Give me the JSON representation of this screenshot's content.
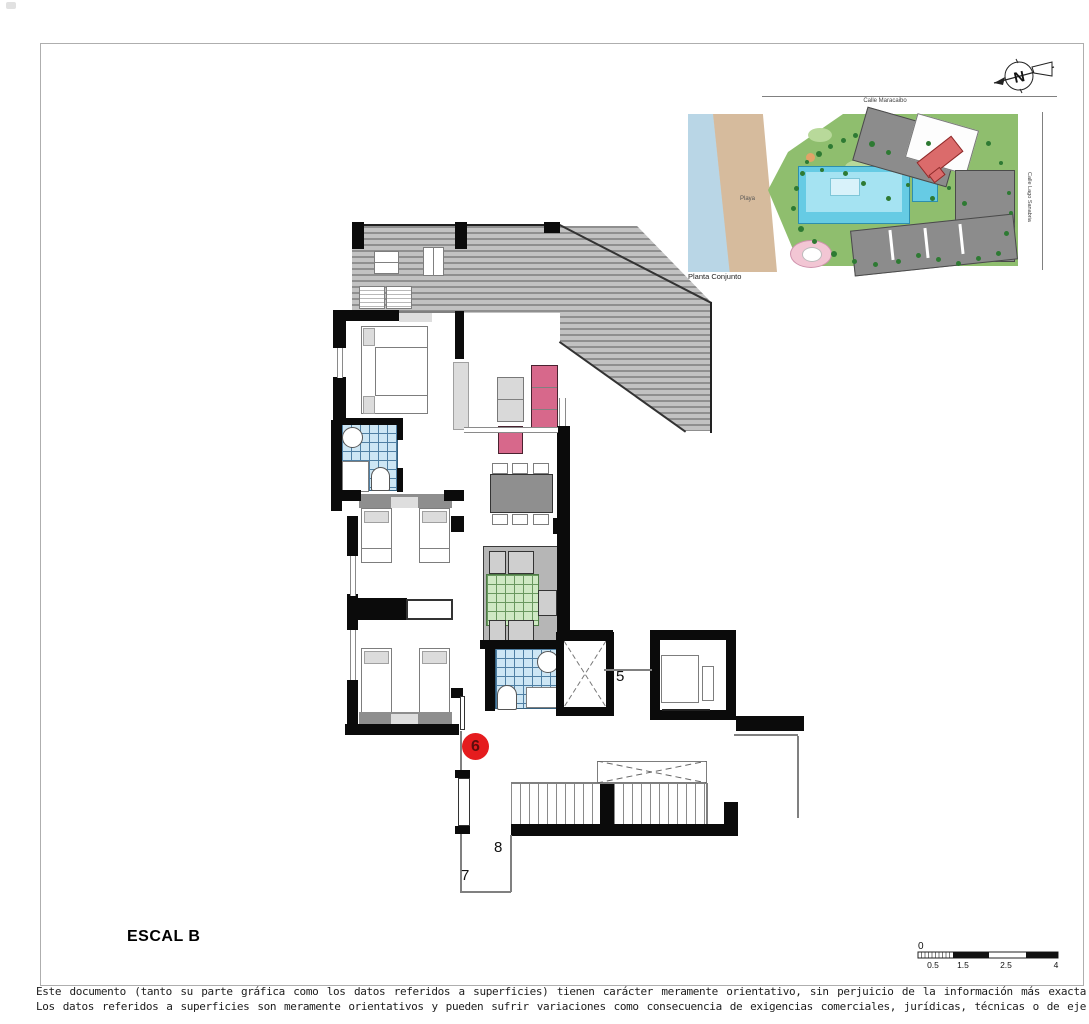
{
  "plan": {
    "title": "ESCAL B",
    "unit_number": "6",
    "elevator_label": "5",
    "landing_label_8": "8",
    "landing_label_7": "7"
  },
  "site_plan": {
    "caption": "Planta Conjunto",
    "road_top_label": "Calle Maracaibo",
    "road_right_label": "Calle Lago Sanabria",
    "beach_label": "Playa",
    "north_label": "N"
  },
  "scale_bar": {
    "zero_label": "0",
    "tick_labels": [
      "0.5",
      "1.5",
      "2.5",
      "4"
    ]
  },
  "disclaimer": {
    "line1": "Este documento (tanto su parte gráfica como los datos referidos a superficies) tienen carácter meramente orientativo, sin perjuicio de la información más exacta",
    "line2": "Los datos referidos a superficies son meramente orientativos y pueden sufrir variaciones como consecuencia de exigencias comerciales, jurídicas, técnicas o de eje"
  },
  "colors": {
    "unit_badge_red": "#e51c1e",
    "pool_cyan": "#66cbe4",
    "bath_tile_blue": "#cde6f4",
    "kitchen_tile_green": "#cfe9c4",
    "furniture_pink": "#d7688b",
    "highlight_building_red": "#db6b6b"
  }
}
